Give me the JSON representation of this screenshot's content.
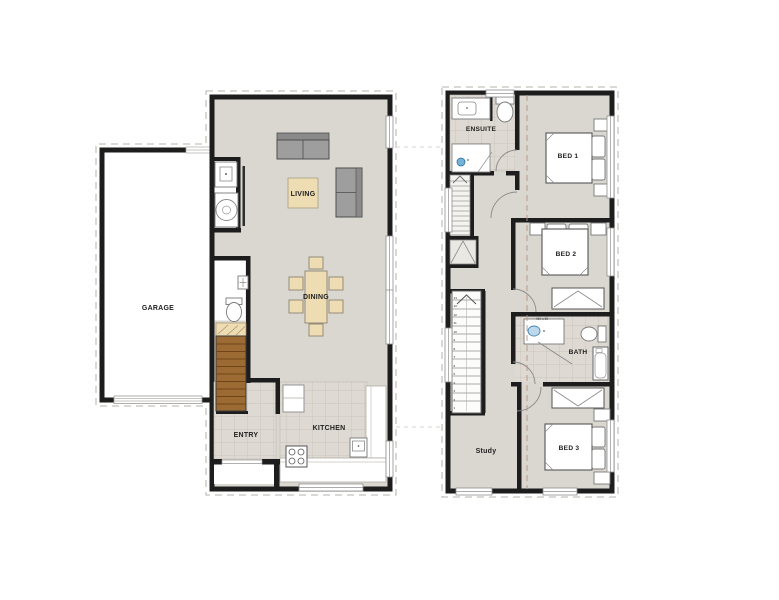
{
  "ground_floor": {
    "rooms": {
      "garage": "GARAGE",
      "living": "LIVING",
      "dining": "DINING",
      "entry": "ENTRY",
      "kitchen": "KITCHEN"
    }
  },
  "upper_floor": {
    "rooms": {
      "ensuite": "ENSUITE",
      "bed1": "BED 1",
      "bed2": "BED 2",
      "bath": "BATH",
      "study": "Study",
      "bed3": "BED 3"
    },
    "stairs": {
      "numbers": [
        "1",
        "2",
        "3",
        "4",
        "5",
        "6",
        "7",
        "8",
        "9",
        "10",
        "11",
        "12",
        "13",
        "14"
      ]
    },
    "bath_note": "460 x 60"
  },
  "palette": {
    "wall": "#1d1d1d",
    "floor": "#d9d7d0",
    "tile": "#dedad3",
    "tile_line": "#c4c0b6",
    "wood_stair": "#9c6b33",
    "tan_furniture": "#eedcb3",
    "sofa_gray": "#9e9e9e",
    "fixture_white": "#ffffff",
    "basin_blue": "#74b2d8",
    "boundary_dash": "#c5c2bb",
    "section_dash": "#b99480"
  }
}
